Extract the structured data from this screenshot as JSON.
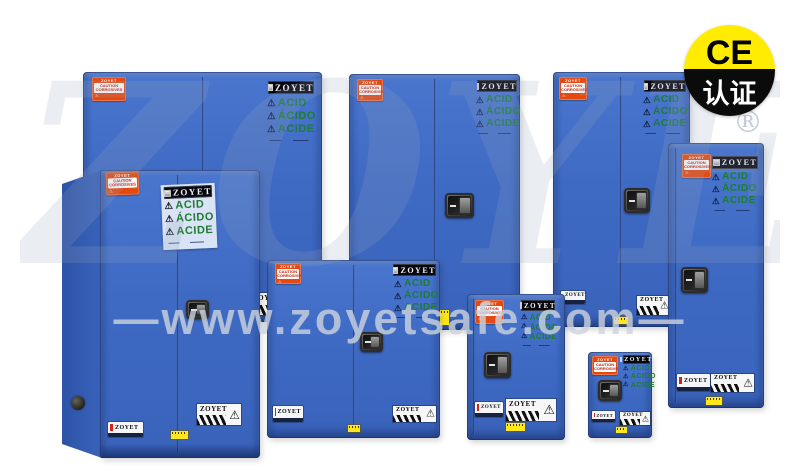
{
  "badge": {
    "top": "CE",
    "bottom": "认证"
  },
  "watermark": {
    "site": "—www.zoyetsafe.com—",
    "ghost_brand": "ZOYET",
    "registered": "®"
  },
  "product_labels": {
    "brand": "ZOYET",
    "hazard_triangle": "⚠",
    "acid_lines": [
      "ACID",
      "ÁCIDO",
      "ACIDE"
    ],
    "caution": {
      "line1": "CAUTION",
      "line2": "CORROSIVES"
    }
  }
}
